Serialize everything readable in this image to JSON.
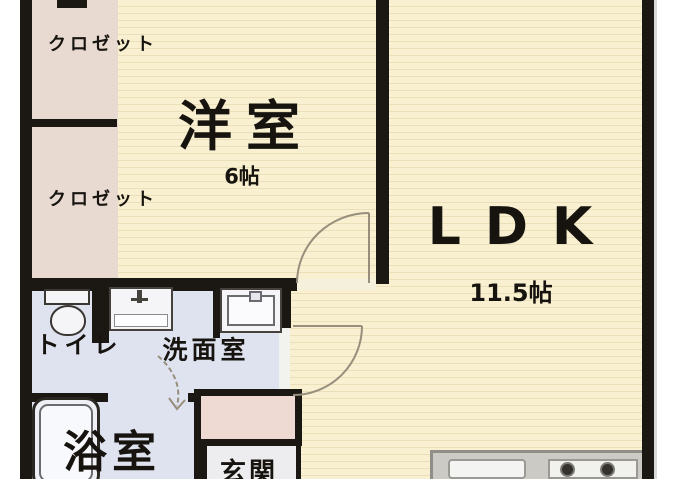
{
  "plan_title": "apartment-floor-plan",
  "rooms": {
    "closet_upper": {
      "label": "クロゼット"
    },
    "closet_lower": {
      "label": "クロゼット"
    },
    "western_room": {
      "label": "洋室",
      "size": "6帖"
    },
    "ldk": {
      "label": "LDK",
      "size": "11.5帖"
    },
    "toilet": {
      "label": "トイレ"
    },
    "washroom": {
      "label": "洗面室"
    },
    "bathroom": {
      "label": "浴室"
    },
    "entrance": {
      "label": "玄関"
    }
  },
  "colors": {
    "wall": "#1b1713",
    "text": "#17140f",
    "floor_main": "#f8f0d0",
    "floor_stripe": "#ebdfb9",
    "floor_closet": "#e8d9d1",
    "floor_wet": "#dfe3f0",
    "floor_entrance": "#ededf0",
    "cabinet": "#eedad3",
    "counter": "#cbcac5",
    "fixture": "#f5f5f8",
    "arc": "#978e7c"
  }
}
